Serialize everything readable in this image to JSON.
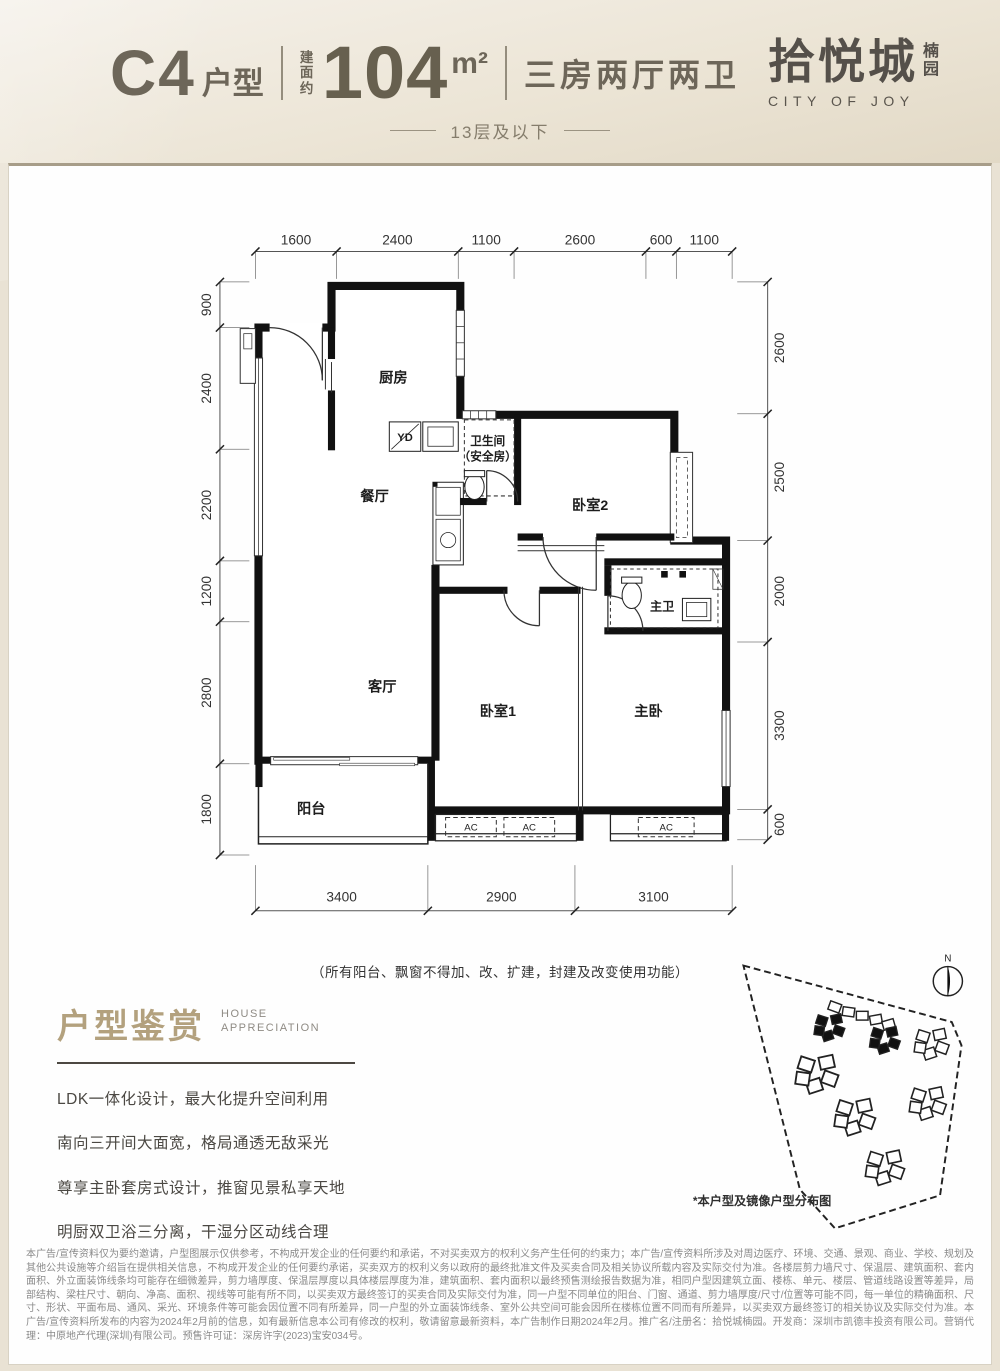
{
  "header": {
    "unit_code": "C4",
    "unit_suffix": "户型",
    "area_prefix": "建面约",
    "area_value": "104",
    "area_unit": "m²",
    "layout_desc": "三房两厅两卫",
    "floor_note": "13层及以下",
    "brand_name": "拾悦城",
    "brand_sub": "楠园",
    "brand_en": "CITY OF JOY"
  },
  "floor_plan": {
    "rooms": {
      "kitchen": "厨房",
      "dining": "餐厅",
      "living": "客厅",
      "balcony": "阳台",
      "bath_line1": "卫生间",
      "bath_line2": "（安全房）",
      "bedroom2": "卧室2",
      "master_bath": "主卫",
      "bedroom1": "卧室1",
      "master": "主卧"
    },
    "fixtures": {
      "yd": "YD",
      "ac": "AC"
    },
    "dims_top": [
      "1600",
      "2400",
      "1100",
      "2600",
      "600",
      "1100"
    ],
    "dims_left": [
      "900",
      "2400",
      "2200",
      "1200",
      "2800",
      "1800"
    ],
    "dims_right": [
      "2600",
      "2500",
      "2000",
      "3300",
      "600"
    ],
    "dims_bottom": [
      "3400",
      "2900",
      "3100"
    ],
    "note": "（所有阳台、飘窗不得加、改、扩建，封建及改变使用功能）"
  },
  "appreciation": {
    "title": "户型鉴赏",
    "subtitle_line1": "HOUSE",
    "subtitle_line2": "APPRECIATION",
    "features": [
      "LDK一体化设计，最大化提升空间利用",
      "南向三开间大面宽，格局通透无敌采光",
      "尊享主卧套房式设计，推窗见景私享天地",
      "明厨双卫浴三分离，干湿分区动线合理"
    ]
  },
  "site_plan": {
    "compass_label": "N",
    "caption": "*本户型及镜像户型分布图"
  },
  "legal": {
    "text": "本广告/宣传资料仅为要约邀请，户型图展示仅供参考，不构成开发企业的任何要约和承诺，不对买卖双方的权利义务产生任何的约束力；本广告/宣传资料所涉及对周边医疗、环境、交通、景观、商业、学校、规划及其他公共设施等介绍旨在提供相关信息，不构成开发企业的任何要约承诺，买卖双方的权利义务以政府的最终批准文件及买卖合同及相关协议所载内容及实际交付为准。各楼层剪力墙尺寸、保温层、建筑面积、套内面积、外立面装饰线条均可能存在细微差异，剪力墙厚度、保温层厚度以具体楼层厚度为准，建筑面积、套内面积以最终预售测绘报告数据为准，相同户型因建筑立面、楼栋、单元、楼层、管道线路设置等差异，局部结构、梁柱尺寸、朝向、净高、面积、视线等可能有所不同，以买卖双方最终签订的买卖合同及实际交付为准，同一户型不同单位的阳台、门窗、通道、剪力墙厚度/尺寸/位置等可能不同，每一单位的精确面积、尺寸、形状、平面布局、通风、采光、环境条件等可能会因位置不同有所差异，同一户型的外立面装饰线条、室外公共空间可能会因所在楼栋位置不同而有所差异，以买卖双方最终签订的相关协议及实际交付为准。本广告/宣传资料所发布的内容为2024年2月前的信息，如有最新信息本公司有修改的权利，敬请留意最新资料，本广告制作日期2024年2月。推广名/注册名：拾悦城楠园。开发商：深圳市凯德丰投资有限公司。营销代理：中原地产代理(深圳)有限公司。预售许可证：深房许字(2023)宝安034号。"
  }
}
